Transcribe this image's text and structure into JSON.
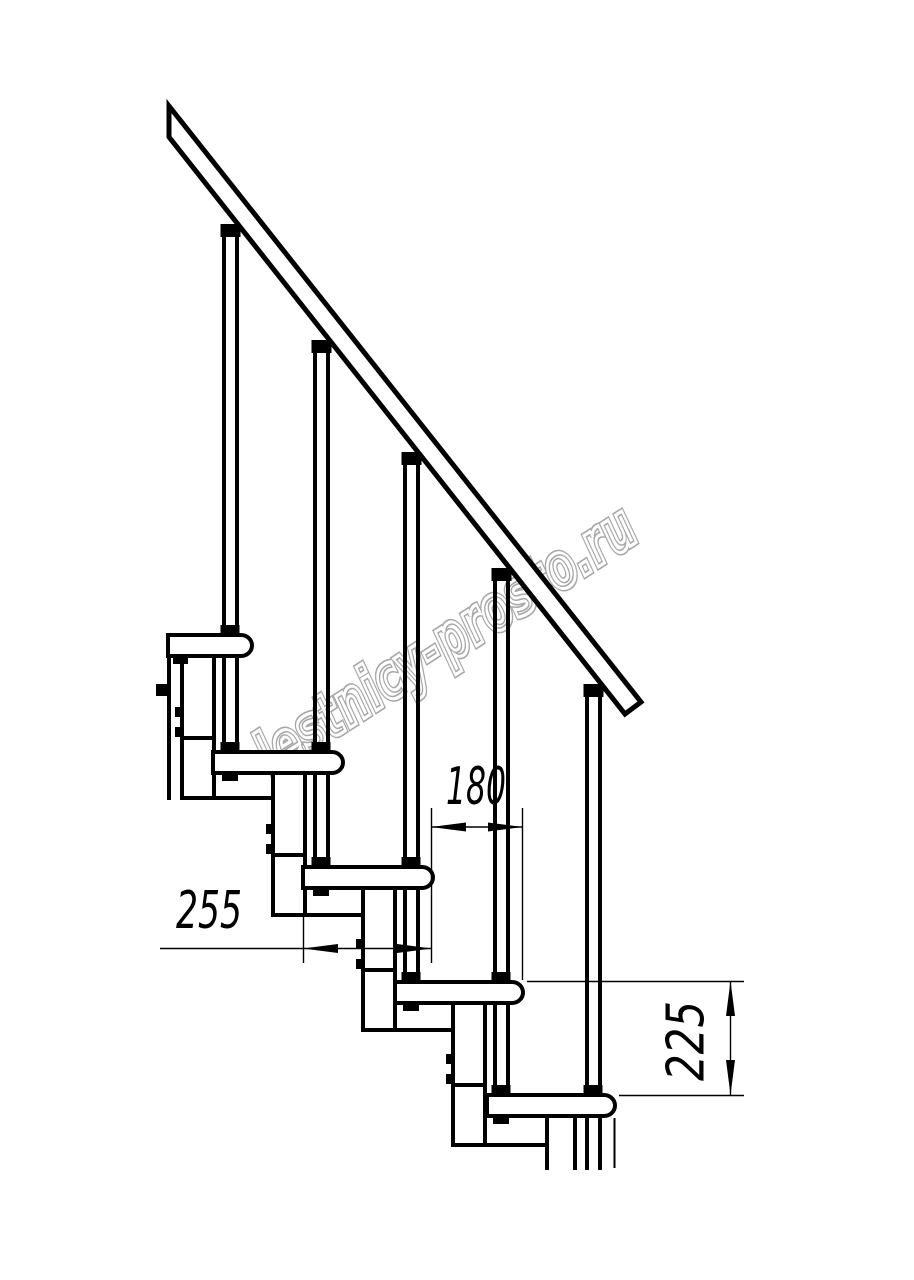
{
  "watermark": {
    "text": "lestnicy-prosto.ru",
    "color": "#a8a8a8"
  },
  "dimensions": {
    "run": {
      "label": "180",
      "orientation": "horizontal"
    },
    "tread_length": {
      "label": "255",
      "orientation": "horizontal"
    },
    "rise": {
      "label": "225",
      "orientation": "vertical"
    }
  },
  "colors": {
    "line": "#000000",
    "background": "#ffffff",
    "dimension_line": "#000000"
  }
}
